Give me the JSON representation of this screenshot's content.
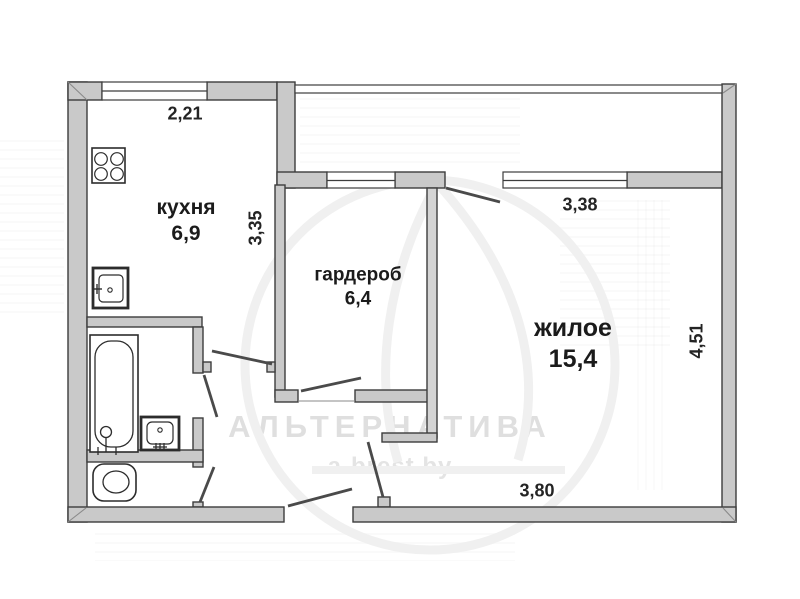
{
  "rooms": {
    "kitchen": {
      "name": "кухня",
      "area": "6,9"
    },
    "wardrobe": {
      "name": "гардероб",
      "area": "6,4"
    },
    "living": {
      "name": "жилое",
      "area": "15,4"
    }
  },
  "dimensions": {
    "kitchen_top": "2,21",
    "kitchen_side": "3,35",
    "living_top": "3,38",
    "living_side": "4,51",
    "living_bottom": "3,80"
  },
  "watermark": {
    "brand": "АЛЬТЕРНАТИВА",
    "site": "a-brest.by"
  },
  "fixtures": {
    "stove": "stove-icon",
    "kitchen_sink": "sink-icon",
    "bathtub": "bathtub-icon",
    "washbasin": "washbasin-icon",
    "toilet": "toilet-icon"
  },
  "colors": {
    "wall_fill": "#c9c9c9",
    "wall_outline": "#3d3d3d",
    "background": "#ffffff",
    "label_text": "#1b1b1b",
    "watermark_text": "#dfdfdf"
  }
}
